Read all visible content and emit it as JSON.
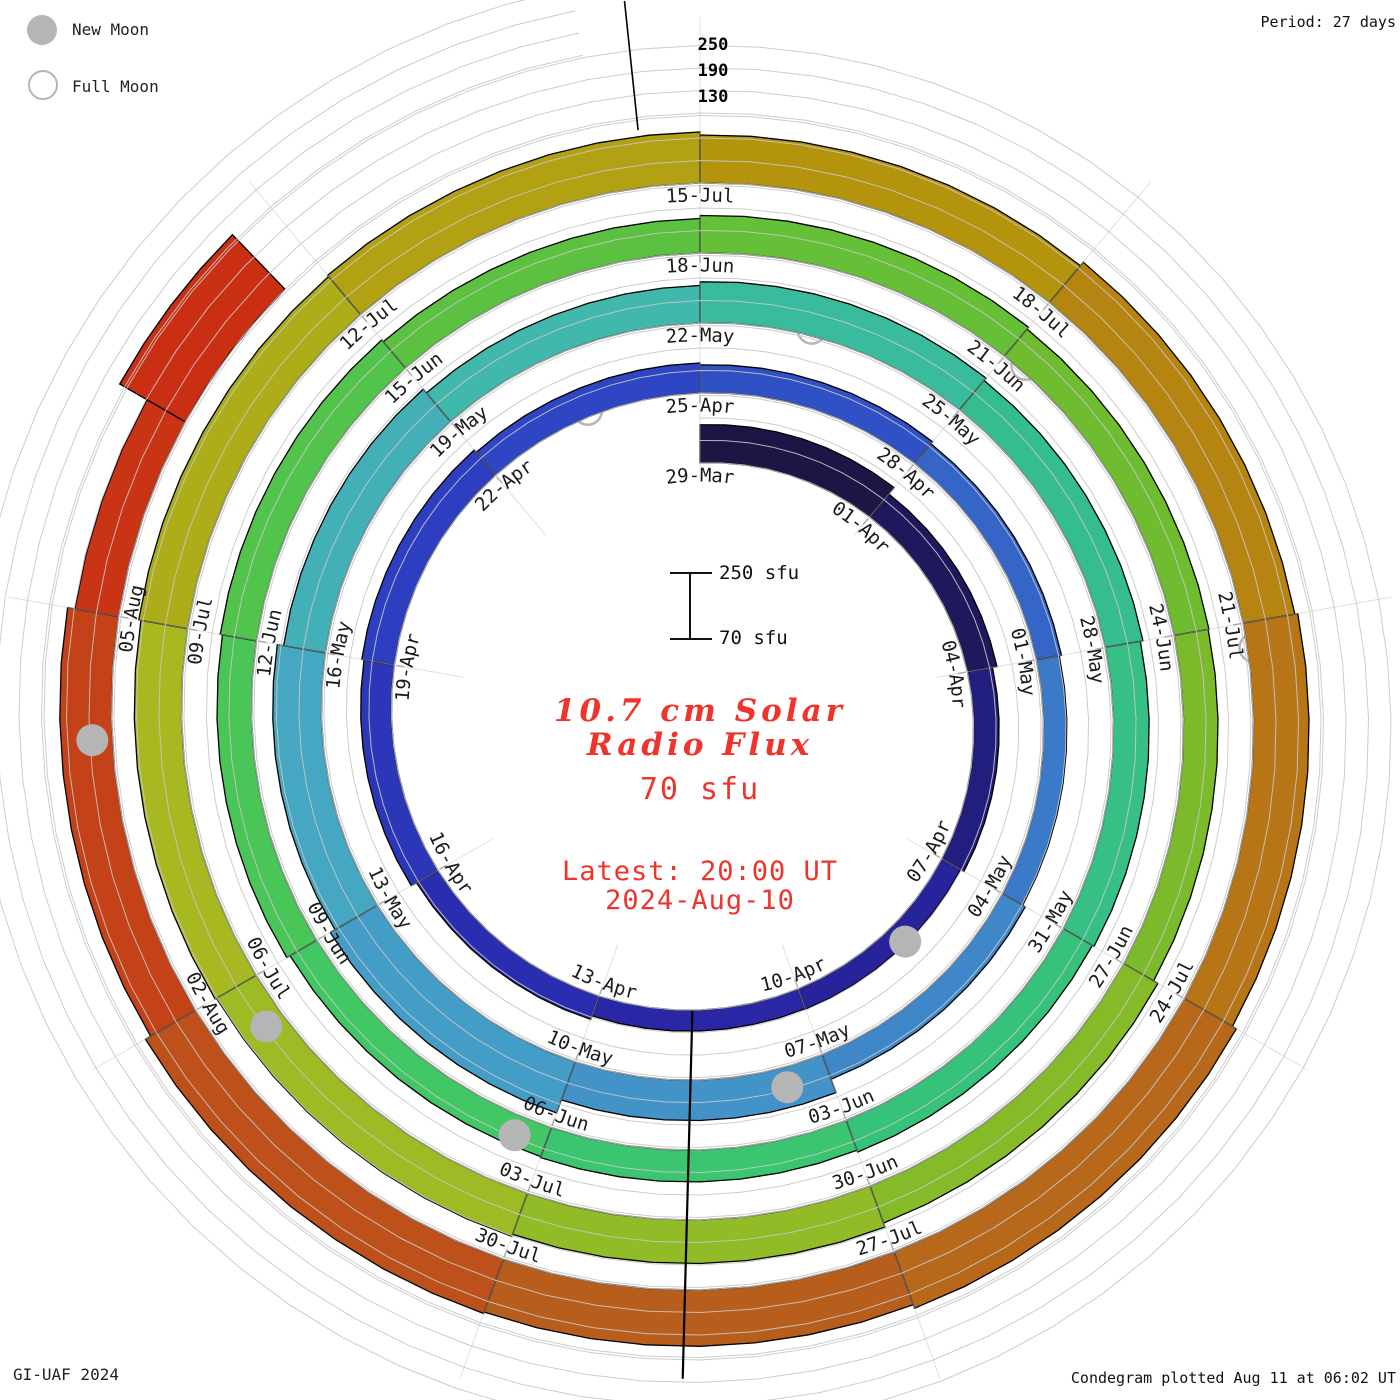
{
  "header": {
    "period_label": "Period: 27 days"
  },
  "legend": {
    "new_moon": "New Moon",
    "full_moon": "Full Moon"
  },
  "footer": {
    "left": "GI-UAF 2024",
    "right": "Condegram plotted Aug 11 at 06:02 UT"
  },
  "center": {
    "title_line1": "10.7 cm Solar",
    "title_line2": "Radio Flux",
    "current_value": "70 sfu",
    "latest_line1": "Latest: 20:00 UT",
    "latest_line2": "2024-Aug-10"
  },
  "scale_bar": {
    "top_label": "250 sfu",
    "bottom_label": "70 sfu"
  },
  "axis": {
    "tick_labels": [
      "250",
      "190",
      "130"
    ]
  },
  "chart_data": {
    "type": "bar",
    "polar": true,
    "title": "10.7 cm Solar Radio Flux",
    "units": "sfu",
    "period_days": 27,
    "days_per_segment": 3,
    "start_label": "29-Mar",
    "baseline_sfu": 70,
    "gridlines_sfu": [
      70,
      130,
      190,
      250
    ],
    "ylim": [
      70,
      250
    ],
    "segments": [
      {
        "label": "29-Mar",
        "d0": 0,
        "nd": 3,
        "v": 172
      },
      {
        "label": "01-Apr",
        "d0": 3,
        "nd": 3,
        "v": 150
      },
      {
        "label": "04-Apr",
        "d0": 6,
        "nd": 3,
        "v": 138
      },
      {
        "label": "07-Apr",
        "d0": 9,
        "nd": 3,
        "v": 128
      },
      {
        "label": "10-Apr",
        "d0": 12,
        "nd": 3,
        "v": 126
      },
      {
        "label": "13-Apr",
        "d0": 15,
        "nd": 3,
        "v": 136
      },
      {
        "label": "16-Apr",
        "d0": 18,
        "nd": 3,
        "v": 152
      },
      {
        "label": "19-Apr",
        "d0": 21,
        "nd": 3,
        "v": 158
      },
      {
        "label": "22-Apr",
        "d0": 24,
        "nd": 3,
        "v": 150
      },
      {
        "label": "25-Apr",
        "d0": 27,
        "nd": 3,
        "v": 145
      },
      {
        "label": "28-Apr",
        "d0": 30,
        "nd": 3,
        "v": 138
      },
      {
        "label": "01-May",
        "d0": 33,
        "nd": 3,
        "v": 132
      },
      {
        "label": "04-May",
        "d0": 36,
        "nd": 3,
        "v": 140
      },
      {
        "label": "07-May",
        "d0": 39,
        "nd": 3,
        "v": 178
      },
      {
        "label": "10-May",
        "d0": 42,
        "nd": 3,
        "v": 215
      },
      {
        "label": "13-May",
        "d0": 45,
        "nd": 3,
        "v": 200
      },
      {
        "label": "16-May",
        "d0": 48,
        "nd": 3,
        "v": 183
      },
      {
        "label": "19-May",
        "d0": 51,
        "nd": 3,
        "v": 170
      },
      {
        "label": "22-May",
        "d0": 54,
        "nd": 3,
        "v": 180
      },
      {
        "label": "25-May",
        "d0": 57,
        "nd": 3,
        "v": 172
      },
      {
        "label": "28-May",
        "d0": 60,
        "nd": 3,
        "v": 165
      },
      {
        "label": "31-May",
        "d0": 63,
        "nd": 3,
        "v": 160
      },
      {
        "label": "03-Jun",
        "d0": 66,
        "nd": 3,
        "v": 155
      },
      {
        "label": "06-Jun",
        "d0": 69,
        "nd": 3,
        "v": 152
      },
      {
        "label": "09-Jun",
        "d0": 72,
        "nd": 3,
        "v": 162
      },
      {
        "label": "12-Jun",
        "d0": 75,
        "nd": 3,
        "v": 168
      },
      {
        "label": "15-Jun",
        "d0": 78,
        "nd": 3,
        "v": 162
      },
      {
        "label": "18-Jun",
        "d0": 81,
        "nd": 3,
        "v": 170
      },
      {
        "label": "21-Jun",
        "d0": 84,
        "nd": 3,
        "v": 164
      },
      {
        "label": "24-Jun",
        "d0": 87,
        "nd": 3,
        "v": 162
      },
      {
        "label": "27-Jun",
        "d0": 90,
        "nd": 3,
        "v": 175
      },
      {
        "label": "30-Jun",
        "d0": 93,
        "nd": 3,
        "v": 186
      },
      {
        "label": "03-Jul",
        "d0": 96,
        "nd": 3,
        "v": 192
      },
      {
        "label": "06-Jul",
        "d0": 99,
        "nd": 3,
        "v": 196
      },
      {
        "label": "09-Jul",
        "d0": 102,
        "nd": 3,
        "v": 202
      },
      {
        "label": "12-Jul",
        "d0": 105,
        "nd": 3,
        "v": 206
      },
      {
        "label": "15-Jul",
        "d0": 108,
        "nd": 3,
        "v": 198
      },
      {
        "label": "18-Jul",
        "d0": 111,
        "nd": 3,
        "v": 210
      },
      {
        "label": "21-Jul",
        "d0": 114,
        "nd": 3,
        "v": 218
      },
      {
        "label": "24-Jul",
        "d0": 117,
        "nd": 3,
        "v": 230
      },
      {
        "label": "27-Jul",
        "d0": 120,
        "nd": 3,
        "v": 220
      },
      {
        "label": "30-Jul",
        "d0": 123,
        "nd": 3,
        "v": 224
      },
      {
        "label": "02-Aug",
        "d0": 126,
        "nd": 3,
        "v": 208
      },
      {
        "label": "05-Aug",
        "d0": 129,
        "nd": 1.5,
        "v": 188
      },
      {
        "label": "",
        "d0": 130.5,
        "nd": 1.2,
        "v": 272
      }
    ],
    "color_stops": [
      {
        "d": 0,
        "c": "#191538"
      },
      {
        "d": 5,
        "c": "#1e1960"
      },
      {
        "d": 10,
        "c": "#262299"
      },
      {
        "d": 16,
        "c": "#2b2bb0"
      },
      {
        "d": 22,
        "c": "#2d3dc0"
      },
      {
        "d": 28,
        "c": "#2f4cc6"
      },
      {
        "d": 34,
        "c": "#3a78c8"
      },
      {
        "d": 40,
        "c": "#4391c9"
      },
      {
        "d": 46,
        "c": "#45a5c4"
      },
      {
        "d": 52,
        "c": "#41b7ae"
      },
      {
        "d": 58,
        "c": "#35bd92"
      },
      {
        "d": 64,
        "c": "#36c27d"
      },
      {
        "d": 70,
        "c": "#3fc766"
      },
      {
        "d": 76,
        "c": "#52c44d"
      },
      {
        "d": 82,
        "c": "#63bf38"
      },
      {
        "d": 88,
        "c": "#78ba2b"
      },
      {
        "d": 94,
        "c": "#8fbc27"
      },
      {
        "d": 100,
        "c": "#a7ba22"
      },
      {
        "d": 106,
        "c": "#b2a414"
      },
      {
        "d": 110,
        "c": "#b5920c"
      },
      {
        "d": 114,
        "c": "#b77c13"
      },
      {
        "d": 118,
        "c": "#b76a1a"
      },
      {
        "d": 122,
        "c": "#b85c1d"
      },
      {
        "d": 126,
        "c": "#c24a1a"
      },
      {
        "d": 130,
        "c": "#c93214"
      },
      {
        "d": 134,
        "c": "#cc2410"
      }
    ],
    "moons": {
      "new_moon_days": [
        10.3,
        39.5,
        69.3,
        98.6,
        128.1
      ],
      "full_moon_days": [
        25.5,
        55.2,
        84.2,
        114.2
      ]
    },
    "style": {
      "grid": "#c6c6c6",
      "tick": "#a9a9a9",
      "moon": "#b5b5b5",
      "segment_stroke": "#000000",
      "label_color": "#1a1a1a",
      "axis_color": "#000000"
    }
  }
}
